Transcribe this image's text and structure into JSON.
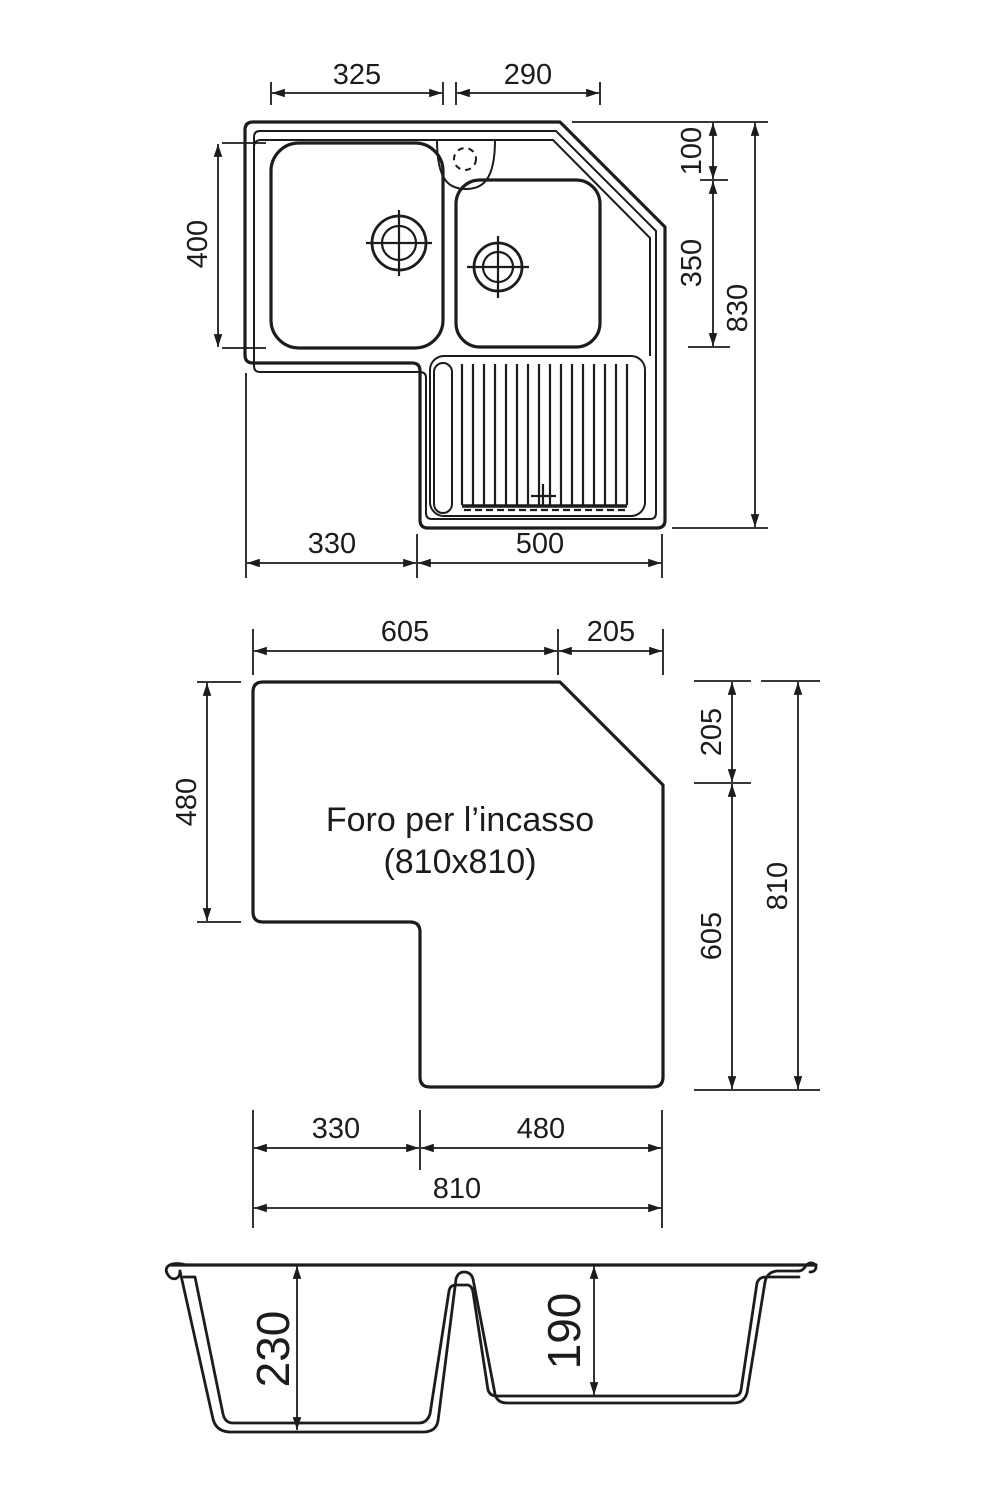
{
  "drawing": {
    "background": "#ffffff",
    "line_color": "#1c1c1c"
  },
  "top_view": {
    "dim_left_basin_width": "325",
    "dim_right_basin_width": "290",
    "dim_left_basin_height": "400",
    "dim_corner_offset": "100",
    "dim_right_basin_height": "350",
    "dim_total_side": "830",
    "dim_bottom_left": "330",
    "dim_bottom_right": "500"
  },
  "cutout_view": {
    "label_line1": "Foro per l’incasso",
    "label_line2": "(810x810)",
    "dim_top_left": "605",
    "dim_top_right": "205",
    "dim_left": "480",
    "dim_right_upper": "205",
    "dim_right_lower": "605",
    "dim_right_total": "810",
    "dim_bottom_left": "330",
    "dim_bottom_right": "480",
    "dim_bottom_total": "810"
  },
  "section_view": {
    "dim_depth_left": "230",
    "dim_depth_right": "190"
  }
}
